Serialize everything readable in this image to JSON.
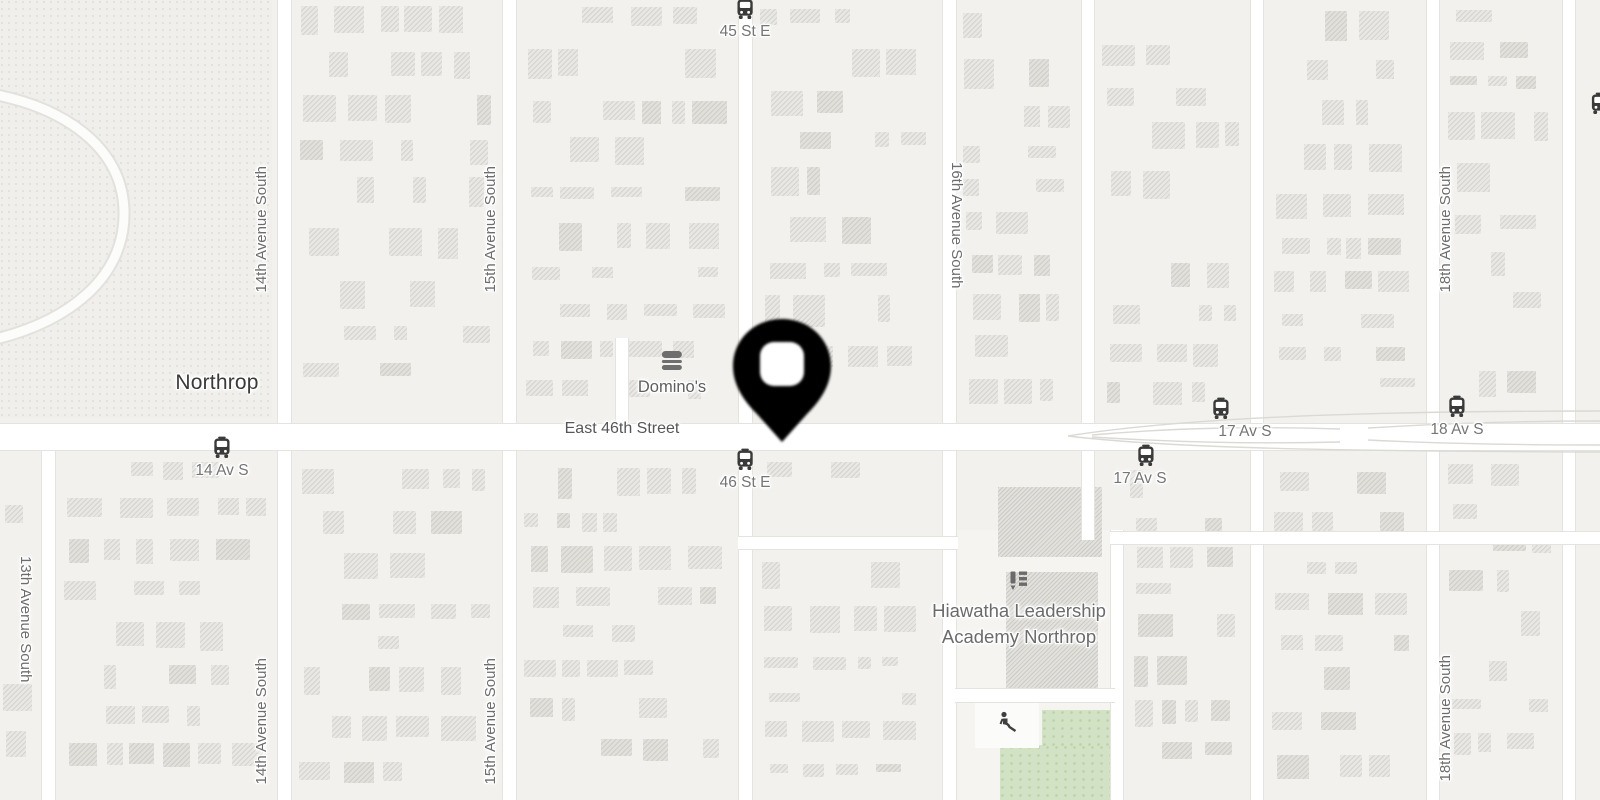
{
  "map": {
    "locality": {
      "name": "Northrop"
    },
    "main_road": {
      "name": "East 46th Street"
    },
    "avenues": {
      "a13": "13th Avenue South",
      "a14": "14th Avenue South",
      "a15": "15th Avenue South",
      "a16": "16th Avenue South",
      "a18": "18th Avenue South"
    },
    "transit_stops": {
      "s45": "45 St E",
      "s46": "46 St E",
      "s14": "14 Av S",
      "s17_south": "17 Av S",
      "s17_north": "17 Av S",
      "s18": "18 Av S"
    },
    "pois": {
      "dominos": {
        "name": "Domino's",
        "icon": "burger-restaurant"
      },
      "school": {
        "line1": "Hiawatha Leadership",
        "line2": "Academy Northrop",
        "icon": "pencil-and-notes"
      },
      "playground": {
        "icon": "person-on-slide"
      }
    },
    "marker": {
      "type": "location-pin",
      "color": "#000000"
    },
    "icons": {
      "bus_stop": "bus-front-view"
    },
    "colors": {
      "background": "#f2f1ee",
      "road_fill": "#ffffff",
      "road_casing": "#e5e3df",
      "building_fill": "#e9e7e3",
      "park_green": "#d2e2c4",
      "campus_fill": "#f5f4f1",
      "label_gray": "#757575",
      "label_dark": "#3a3a3a",
      "transit_icon": "#3a3a3a"
    }
  }
}
